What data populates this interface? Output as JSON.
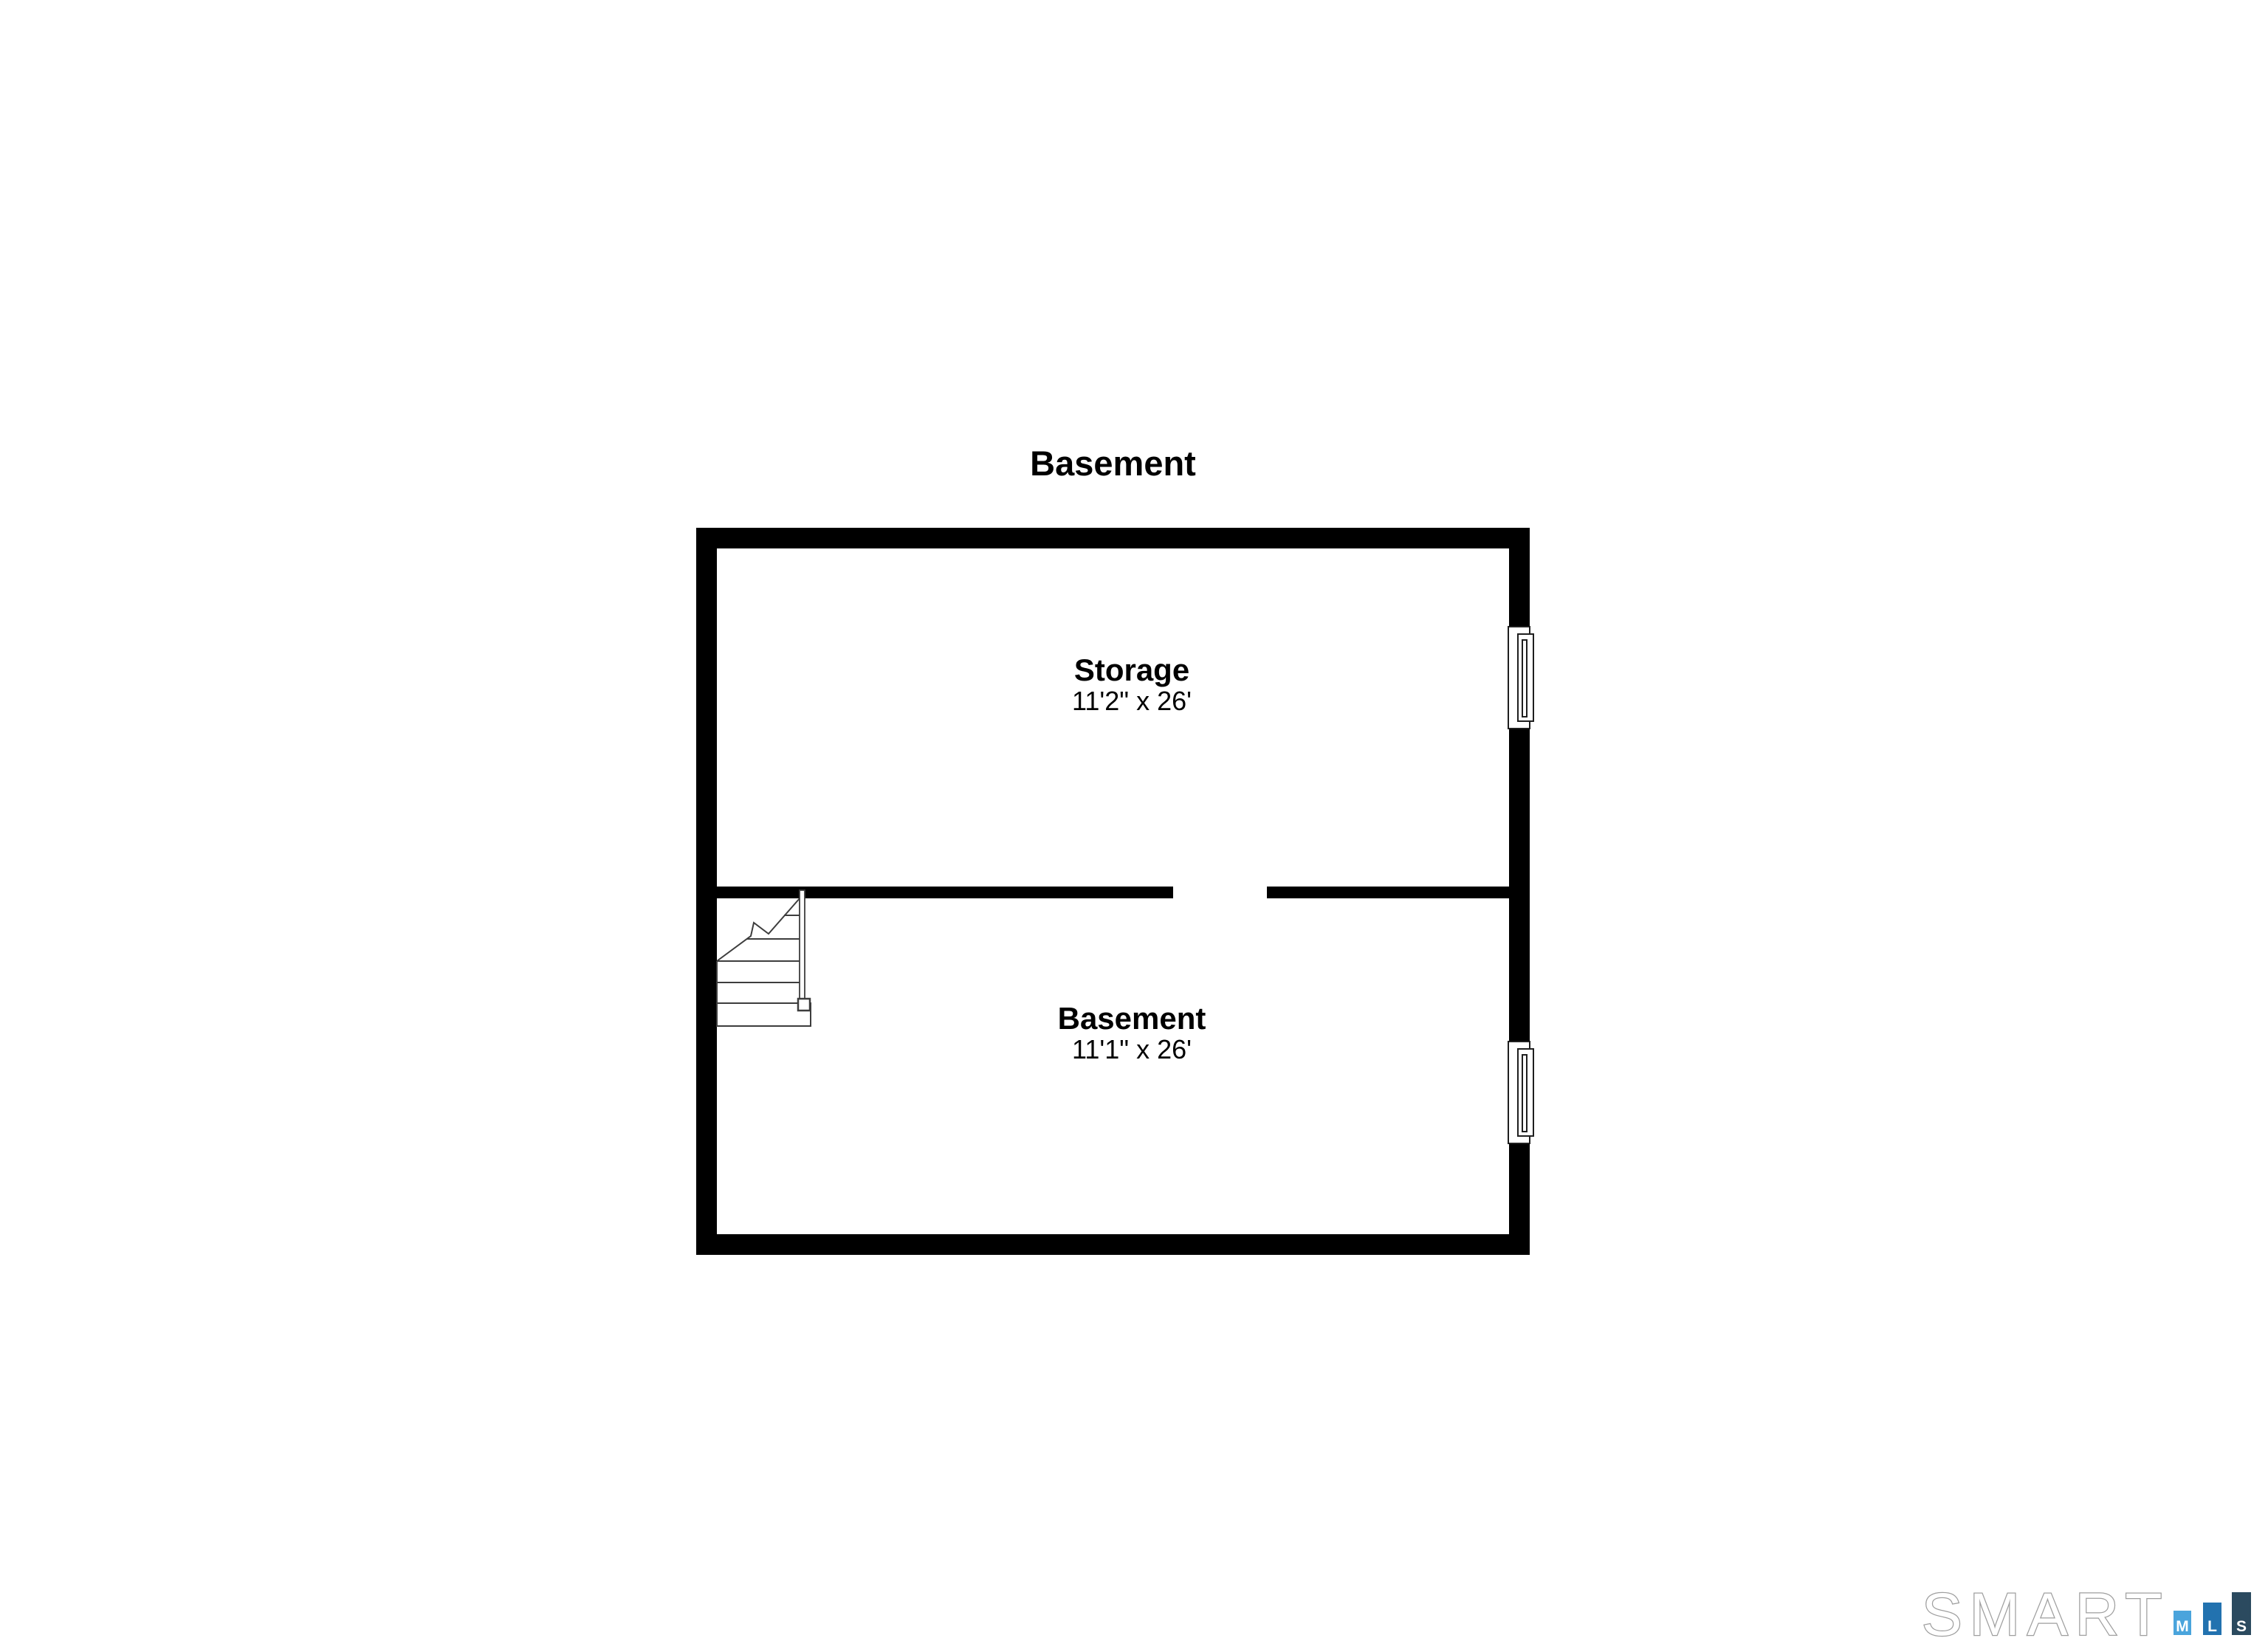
{
  "page": {
    "title": "Basement",
    "background_color": "#ffffff"
  },
  "floor_plan": {
    "wall_color": "#000000",
    "symbol_line_color": "#3d3d3d",
    "window_line_color": "#1f1f1f",
    "rooms": [
      {
        "name": "Storage",
        "dimensions": "11'2\" x 26'"
      },
      {
        "name": "Basement",
        "dimensions": "11'1\" x 26'"
      }
    ]
  },
  "branding": {
    "wordmark": "SMART",
    "wordmark_outline_color": "#9e9e9e",
    "wordmark_fill_color": "#ffffff",
    "mls": [
      {
        "letter": "M",
        "color": "#4AA4DC"
      },
      {
        "letter": "L",
        "color": "#2272AF"
      },
      {
        "letter": "S",
        "color": "#2B4A5F"
      }
    ]
  }
}
